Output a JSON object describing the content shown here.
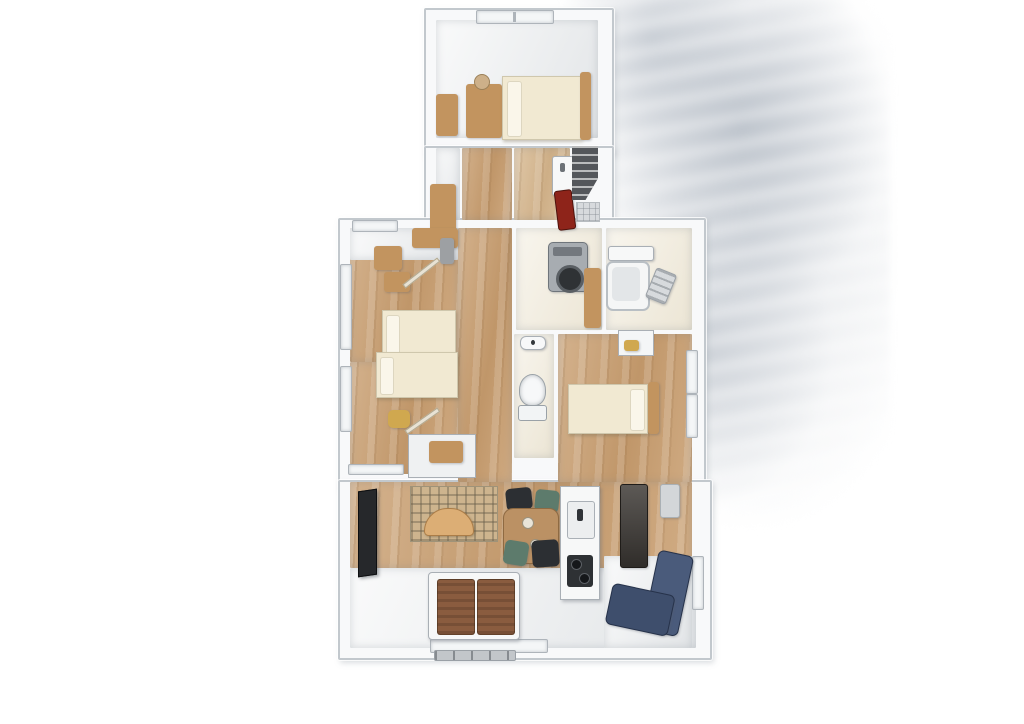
{
  "meta": {
    "scene": "watercolor-style 3D top-down floor plan rendering of an apartment",
    "visible_text": "none"
  },
  "palette": {
    "background": "#ffffff",
    "shadow_wash": "#c5cbd2",
    "wall": "#f8f9fa",
    "wall_line": "#c2c8cd",
    "wood_floor": "#c99f71",
    "wood_floor_light": "#d9bb93",
    "white_floor": "#eff1f2",
    "cream_floor": "#f2ecdd",
    "bed_cream": "#f1e9d2",
    "bed_pillow": "#faf6ea",
    "wood_furniture": "#c2945f",
    "closet_panel": "#9da0a3",
    "tv_black": "#26282b",
    "rug_base": "#cdb48e",
    "sofa_tan": "#dcae75",
    "chair_black": "#2c2f33",
    "chair_teal": "#5d7b6c",
    "table_wood": "#bb9164",
    "counter_white": "#f7f8f8",
    "sink_white": "#eceeef",
    "stove_black": "#2e3134",
    "cabinet_dark": "#403c38",
    "sofa_navy": "#4a5b7b",
    "sofa_navy_dark": "#3e4e6c",
    "futon_brown": "#8a5c3f",
    "red_appliance": "#8e241a",
    "stairs_dark": "#54575b",
    "washer_gray": "#a7acb1",
    "washer_lid": "#2f3235",
    "window_white": "#f4f6f7",
    "threshold_gray": "#c2c6ca",
    "tub_white": "#f5f6f6",
    "tub_inner": "#e3e6e8",
    "toilet_white": "#f7f8f9",
    "stool_yellow": "#d0a84f",
    "tile_gray": "#d7dadd",
    "vent_gray": "#d3d6d9"
  },
  "rooms": [
    {
      "id": "bedroom-north",
      "label": "north bedroom"
    },
    {
      "id": "upper-hallway",
      "label": "upper hallway"
    },
    {
      "id": "washroom-vanity",
      "label": "washroom with vanity"
    },
    {
      "id": "staircase",
      "label": "staircase"
    },
    {
      "id": "bedroom-west-upper",
      "label": "west bedroom upper"
    },
    {
      "id": "bedroom-west-lower",
      "label": "west bedroom lower"
    },
    {
      "id": "central-hallway",
      "label": "central hallway"
    },
    {
      "id": "laundry-room",
      "label": "laundry room"
    },
    {
      "id": "bathroom",
      "label": "bathroom with tub"
    },
    {
      "id": "toilet-room",
      "label": "toilet room"
    },
    {
      "id": "master-bedroom",
      "label": "master bedroom"
    },
    {
      "id": "living-dining-kitchen",
      "label": "living dining kitchen"
    },
    {
      "id": "sleeping-area-south",
      "label": "futon sleeping area"
    }
  ],
  "furniture": [
    "bed",
    "dresser",
    "wood-mat",
    "window",
    "vanity",
    "refrigerator-red",
    "stairs",
    "closet",
    "desk",
    "stool",
    "toilet",
    "hand-basin",
    "washing-machine",
    "shelf",
    "bathtub",
    "bath-counter",
    "shower-rack",
    "tv",
    "rug",
    "curved-sofa",
    "dining-table",
    "chair",
    "kitchen-counter",
    "sink",
    "stove",
    "tall-cabinet",
    "navy-sofa",
    "futon-mat",
    "balcony-step",
    "vent-panel"
  ]
}
